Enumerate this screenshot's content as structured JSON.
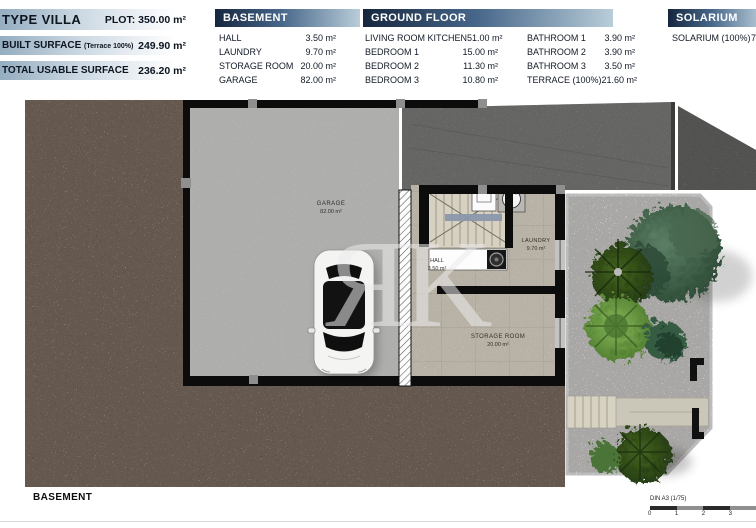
{
  "header": {
    "title_block": {
      "title": "TYPE VILLA",
      "plot": "PLOT: 350.00 m²",
      "rows": [
        {
          "label": "BUILT SURFACE",
          "note": "(Terrace 100%)",
          "value": "249.90 m²"
        },
        {
          "label": "TOTAL USABLE SURFACE",
          "note": "",
          "value": "236.20 m²"
        }
      ]
    },
    "tables": {
      "basement": {
        "title": "BASEMENT",
        "rows": [
          {
            "label": "HALL",
            "value": "3.50 m²"
          },
          {
            "label": "LAUNDRY",
            "value": "9.70 m²"
          },
          {
            "label": "STORAGE ROOM",
            "value": "20.00 m²"
          },
          {
            "label": "GARAGE",
            "value": "82.00 m²"
          }
        ]
      },
      "ground_floor": {
        "title": "GROUND FLOOR",
        "rows_left": [
          {
            "label": "LIVING ROOM KITCHEN",
            "value": "51.00 m²"
          },
          {
            "label": "BEDROOM 1",
            "value": "15.00 m²"
          },
          {
            "label": "BEDROOM 2",
            "value": "11.30 m²"
          },
          {
            "label": "BEDROOM 3",
            "value": "10.80 m²"
          }
        ],
        "rows_right": [
          {
            "label": "BATHROOM 1",
            "value": "3.90 m²"
          },
          {
            "label": "BATHROOM 2",
            "value": "3.90 m²"
          },
          {
            "label": "BATHROOM 3",
            "value": "3.50 m²"
          },
          {
            "label": "TERRACE (100%)",
            "value": "21.60 m²"
          }
        ]
      },
      "solarium": {
        "title": "SOLARIUM",
        "rows": [
          {
            "label": "SOLARIUM (100%)",
            "value": "7"
          }
        ]
      }
    }
  },
  "plan": {
    "watermark": "ЯK",
    "rooms": [
      {
        "name": "GARAGE",
        "area": "82.00 m²"
      },
      {
        "name": "HALL",
        "area": "3.50 m²"
      },
      {
        "name": "LAUNDRY",
        "area": "9.70 m²"
      },
      {
        "name": "STORAGE ROOM",
        "area": "20.00 m²"
      }
    ]
  },
  "footer": {
    "plan_title": "BASEMENT",
    "scale_label": "DIN A3 (1/75)",
    "scale_ticks": [
      "0",
      "1",
      "2",
      "3"
    ]
  },
  "colors": {
    "table_header_dark": "#16263e",
    "table_header_light": "#b9cdd9",
    "terrain_brown": "#73543f",
    "garage_floor": "#b3b3b1",
    "ramp_gray": "#767674",
    "tile_floor": "#c9c3b2",
    "gravel": "#dddcd8",
    "wall_black": "#0c0c0c"
  }
}
